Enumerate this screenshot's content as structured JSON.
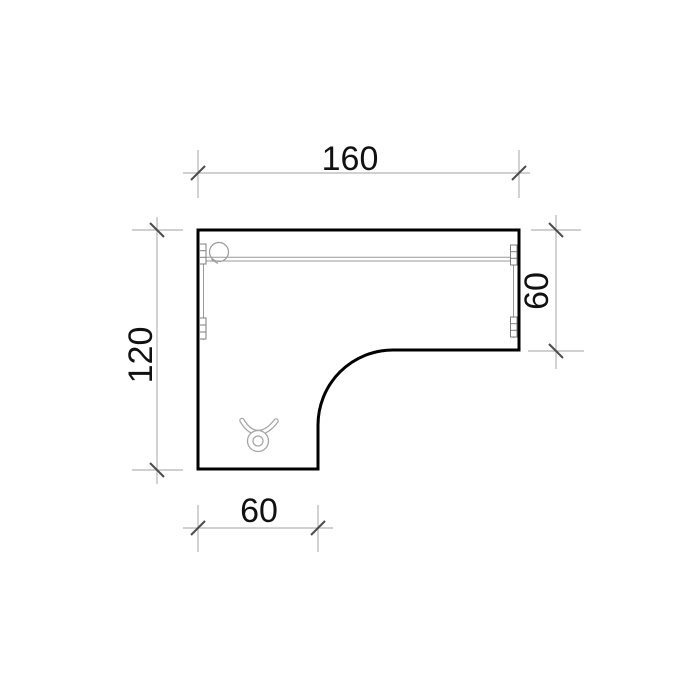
{
  "drawing": {
    "dimensions": {
      "top_width": "160",
      "left_depth": "120",
      "right_depth": "60",
      "bottom_leg_width": "60"
    },
    "colors": {
      "outline": "#000000",
      "dim_line": "#b3b3b3",
      "tick": "#4d4d4d",
      "detail": "#9a9a9a",
      "label": "#111111",
      "background": "#ffffff"
    },
    "icons": [
      "cable-grommet-icon",
      "caster-icon",
      "mounting-bracket-icon"
    ]
  }
}
